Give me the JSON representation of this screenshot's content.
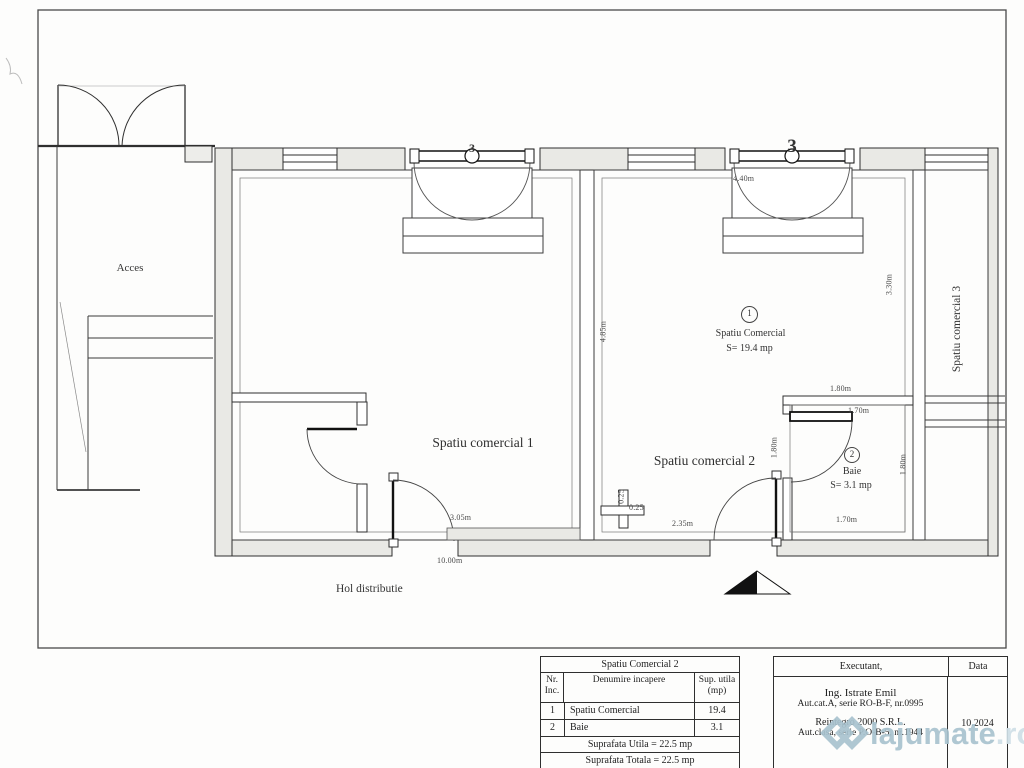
{
  "plan": {
    "acces": "Acces",
    "hol": "Hol distributie",
    "room1": {
      "label": "Spatiu comercial 1"
    },
    "room2": {
      "label": "Spatiu comercial 2",
      "marker": "1",
      "name": "Spatiu Comercial",
      "area": "S= 19.4 mp"
    },
    "baie": {
      "marker": "2",
      "name": "Baie",
      "area": "S= 3.1 mp"
    },
    "room3": {
      "label": "Spatiu comercial 3"
    },
    "door1_marker": "3",
    "door2_marker": "3",
    "dims": {
      "room2_door_width": "4.40m",
      "room2_height": "4.85m",
      "room2_right": "3.30m",
      "baie_top": "1.80m",
      "baie_door": "1.70m",
      "baie_left": "1.80m",
      "baie_right": "1.80m",
      "baie_bottom": "1.70m",
      "room2_bottom": "2.35m",
      "step_v": "0.25",
      "step_h": "0.25",
      "room1_bottom": "3.05m",
      "hol_length": "10.00m"
    }
  },
  "room_table": {
    "title": "Spatiu Comercial 2",
    "headers": {
      "nr": "Nr. Inc.",
      "name": "Denumire incapere",
      "area": "Sup. utila (mp)"
    },
    "rows": [
      {
        "nr": "1",
        "name": "Spatiu Comercial",
        "area": "19.4"
      },
      {
        "nr": "2",
        "name": "Baie",
        "area": "3.1"
      }
    ],
    "footer_utila": "Suprafata Utila = 22.5 mp",
    "footer_totala": "Suprafata Totala = 22.5 mp"
  },
  "title_block": {
    "executant_label": "Executant,",
    "data_label": "Data",
    "line1": "Ing. Istrate Emil",
    "line2": "Aut.cat.A, serie RO-B-F, nr.0995",
    "line3": "Reintegro 2000 S.R.L.",
    "line4": "Aut.clasa, serie P.O-B-5, nr.1944",
    "date": "10.2024"
  },
  "watermark": {
    "name": "lajumate",
    "tld": ".ro"
  }
}
